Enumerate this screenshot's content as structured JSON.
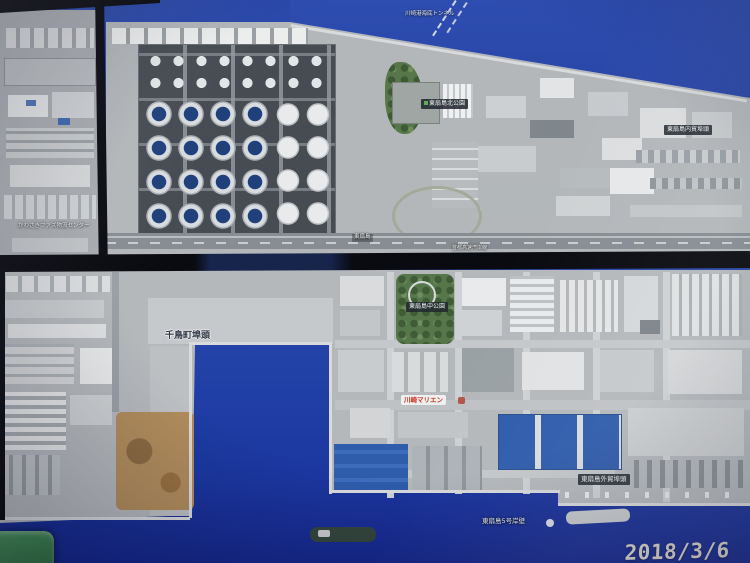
{
  "colors": {
    "water-top": "#2c4bad",
    "water-deep": "#1b37a0",
    "land": "#b4b8bb",
    "seam": "#0b0c12",
    "park-green": "#56774a",
    "roof-blue": "#2f5cab",
    "tank-floor": "#474c52",
    "dirt-tan": "#b08c5c",
    "marien-red": "#cc3322",
    "handle-green": "#3a7d46",
    "stamp": "#d9d5cb"
  },
  "map_labels": {
    "tunnel": "川崎港海底トンネル",
    "north_park": "東扇島北公園",
    "domestic_wharf": "東扇島内貿埠頭",
    "faz_center": "かわさきファズ物流センター",
    "island": "東扇島",
    "bayshore_route": "首都高速湾岸線",
    "chidori_wharf": "千鳥町埠頭",
    "central_park": "東扇島中公園",
    "marien": "川崎マリエン",
    "foreign_wharf": "東扇島外貿埠頭",
    "berth5": "東扇島5号岸壁"
  },
  "camera": {
    "timestamp": "2018/3/6  15:57"
  }
}
